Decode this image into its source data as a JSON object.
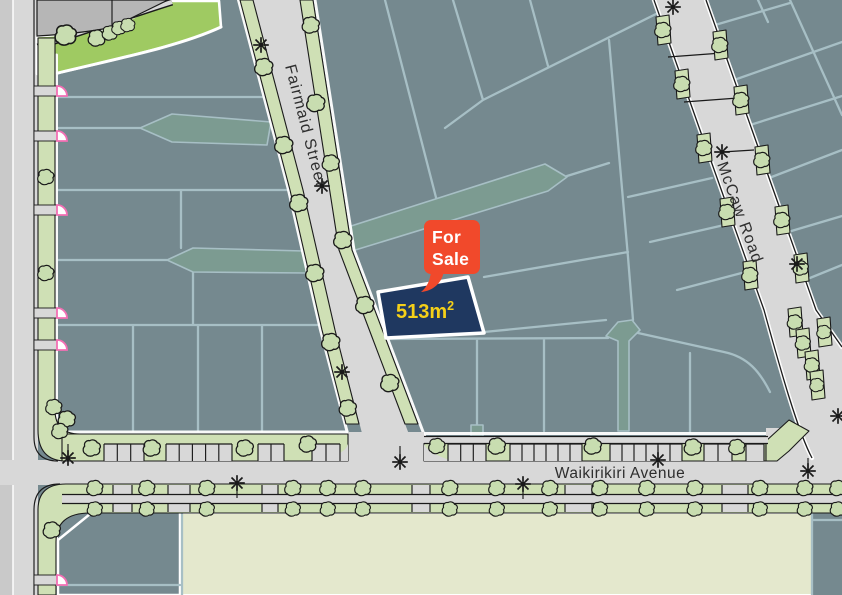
{
  "map": {
    "streets": {
      "fairmaid": "Fairmaid Street",
      "mccaw": "McCaw Road",
      "waikirikiri": "Waikirikiri Avenue"
    },
    "listing": {
      "flag_line1": "For",
      "flag_line2": "Sale",
      "area_value": "513m",
      "area_superscript": "2"
    }
  },
  "colors": {
    "lot_fill": "#75898F",
    "lot_line": "#A7BFC5",
    "laneway": "#7C9B91",
    "road": "#D8D8D8",
    "road_shoulder": "#C9C9C9",
    "berm_green": "#CFE0B5",
    "reserve_green": "#9FCA62",
    "park_green": "#E4E8CD",
    "tree_green": "#C8DDB0",
    "for_sale_lot_navy": "#1F3860",
    "flag_orange": "#F1492B",
    "area_yellow": "#F5D018",
    "driveway_pink": "#F36FB4",
    "outline_ink": "#1A1A1A",
    "label_gray": "#2E2E2E",
    "existing_block_gray": "#B6B6B6",
    "edge_white": "#FFFFFF"
  },
  "icons": {
    "tree": "tree-icon",
    "street_light": "street-light-icon",
    "driveway_marker": "driveway-marker-icon"
  }
}
